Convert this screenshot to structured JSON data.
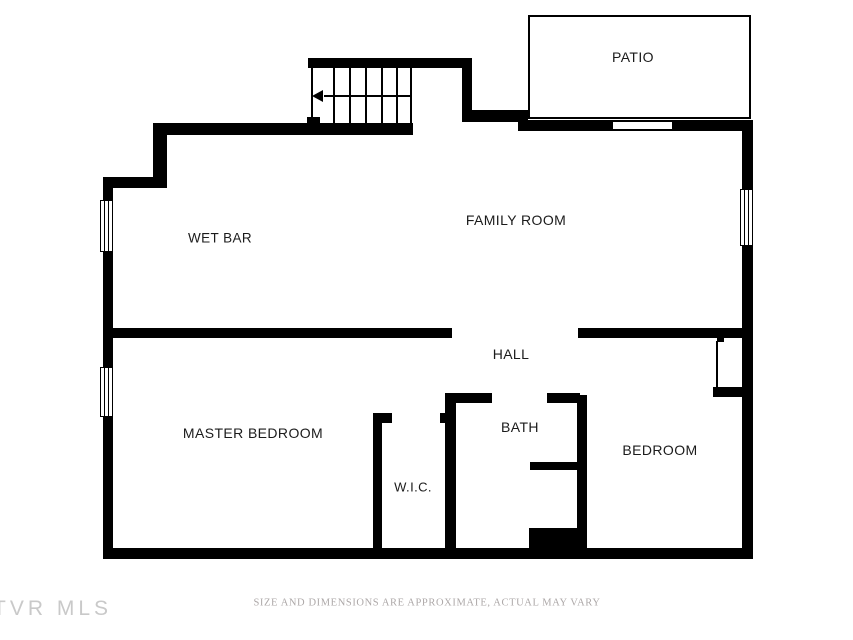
{
  "image_type": "residential-floor-plan",
  "rooms": {
    "patio": "PATIO",
    "family_room": "FAMILY ROOM",
    "wet_bar": "WET BAR",
    "master_bedroom": "MASTER BEDROOM",
    "hall": "HALL",
    "bath": "BATH",
    "wic": "W.I.C.",
    "bedroom": "BEDROOM"
  },
  "stairs": {
    "tread_count": 6,
    "direction_arrow": "left"
  },
  "footer": {
    "disclaimer": "SIZE AND DIMENSIONS ARE APPROXIMATE, ACTUAL MAY VARY",
    "watermark": "TVR MLS"
  },
  "colors": {
    "wall": "#000000",
    "room_label": "#1b1b1b",
    "disclaimer_text": "#ada8a8",
    "watermark_text": "#c9c9c9",
    "background": "#ffffff"
  }
}
